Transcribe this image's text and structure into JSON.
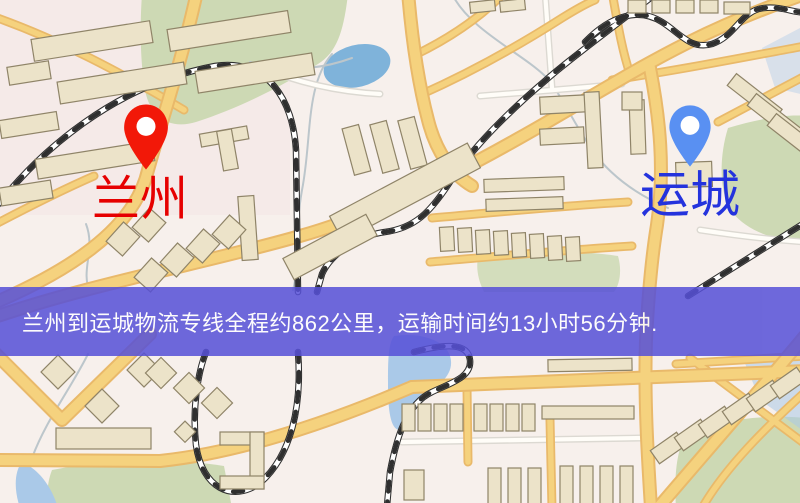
{
  "banner": {
    "text": "兰州到运城物流专线全程约862公里，运输时间约13小时56分钟.",
    "bg_color": "#5650d8",
    "text_color": "#ffffff"
  },
  "route": {
    "origin": "兰州",
    "destination": "运城",
    "distance_text": "约862公里",
    "duration_text": "约13小时56分钟"
  },
  "markers": {
    "origin": {
      "name": "兰州"
    },
    "destination": {
      "name": "运城"
    }
  },
  "map": {
    "colors": {
      "map_bg": "#f7f0ec",
      "road_yellow": "#f5d27e",
      "road_casing": "#e9b96a",
      "building_fill": "#ece3c9",
      "building_stroke": "#8f8468",
      "park_green": "#cdd9b4",
      "water_blue": "#7fb3da",
      "water_light": "#aac9e8",
      "rail_black": "#2f2f2f",
      "banner_bg": "#5650d8",
      "banner_text": "#ffffff",
      "pin_origin": "#f21808",
      "pin_destination": "#5990f2",
      "label_origin": "#e60000",
      "label_destination": "#2433dd"
    }
  }
}
